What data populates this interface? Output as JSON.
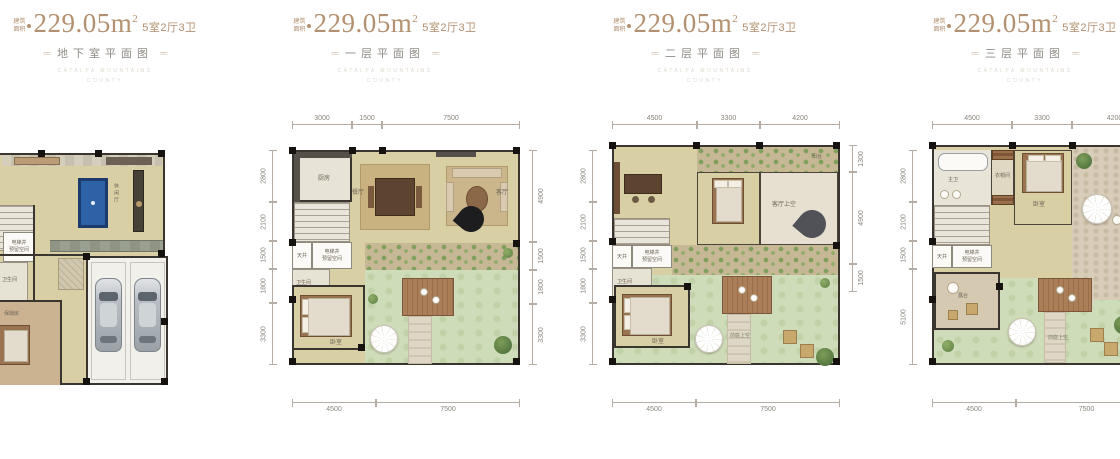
{
  "colors": {
    "accent": "#b3906f",
    "title_gray": "#8f8b86",
    "plan_floor": "#d8cfa4",
    "garden_green": "#cfdcb9",
    "billiard_blue": "#2e62a6"
  },
  "header": {
    "area_label_line1": "建筑",
    "area_label_line2": "面积",
    "area_value": "229.05",
    "area_unit": "m",
    "area_exponent": "2",
    "spec": "5室2厅3卫",
    "flourish": "≈≈"
  },
  "watermark": {
    "line1": "CATALPA MOUNTAINS",
    "line2": "COUNTY"
  },
  "panels": [
    {
      "title": "地下室平面图",
      "rooms": {
        "leisure": "休闲厅",
        "elevator_line1": "电梯井",
        "elevator_line2": "预留空间",
        "bath": "卫生间",
        "nanny": "保姆房"
      }
    },
    {
      "title": "一层平面图",
      "rooms": {
        "kitchen": "厨房",
        "dining": "餐厅",
        "living": "客厅",
        "lightwell": "天井",
        "elevator_line1": "电梯井",
        "elevator_line2": "预留空间",
        "bath": "卫生间",
        "bedroom": "卧室"
      },
      "dims": {
        "top": [
          "3000",
          "1500",
          "7500"
        ],
        "left": [
          "2800",
          "2100",
          "1500",
          "1800",
          "3300"
        ],
        "right": [
          "4900",
          "1500",
          "1800",
          "3300"
        ],
        "bottom": [
          "4500",
          "7500"
        ]
      }
    },
    {
      "title": "二层平面图",
      "rooms": {
        "balcony": "阳台",
        "living_void": "客厅上空",
        "lightwell": "天井",
        "elevator_line1": "电梯井",
        "elevator_line2": "预留空间",
        "bath": "卫生间",
        "bedroom": "卧室",
        "front_void": "前庭上空"
      },
      "dims": {
        "top": [
          "4500",
          "3300",
          "4200"
        ],
        "left": [
          "2800",
          "2100",
          "1500",
          "1800",
          "3300"
        ],
        "right": [
          "1300",
          "4900",
          "1500"
        ],
        "bottom": [
          "4500",
          "7500"
        ]
      }
    },
    {
      "title": "三层平面图",
      "rooms": {
        "master_bath": "主卫",
        "closet": "衣帽间",
        "bedroom": "卧室",
        "lightwell": "天井",
        "elevator_line1": "电梯井",
        "elevator_line2": "预留空间",
        "terrace": "露台",
        "front_void": "前庭上空"
      },
      "dims": {
        "top": [
          "4500",
          "3300",
          "4200"
        ],
        "left": [
          "2800",
          "2100",
          "1500",
          "5100"
        ],
        "bottom": [
          "4500",
          "7500"
        ]
      }
    }
  ]
}
